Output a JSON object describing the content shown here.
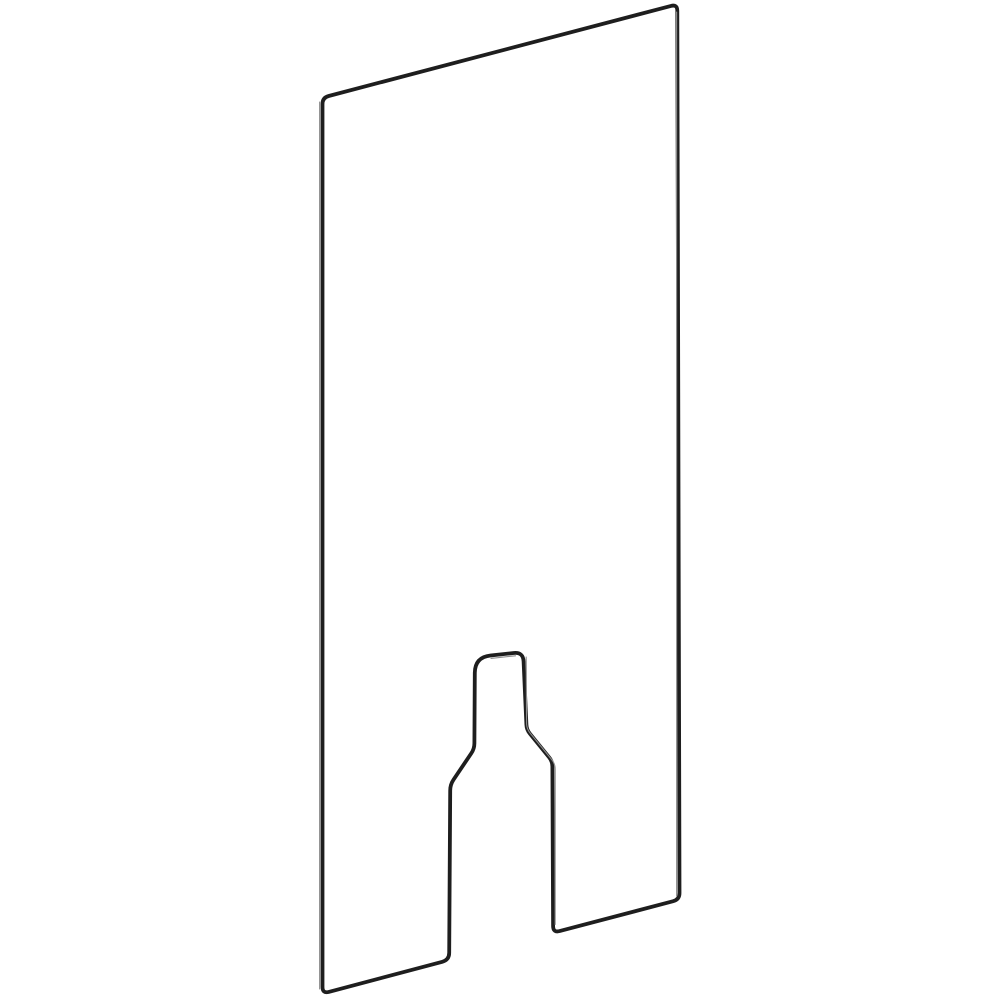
{
  "illustration": {
    "subject": "rectangular-panel-with-bottle-shaped-cutout",
    "view": "perspective-outline-drawing",
    "viewbox": "0 0 1000 1000",
    "colors": {
      "background": "#ffffff",
      "stroke_main": "#1e1e1e",
      "stroke_thin": "#8e8e8e"
    },
    "paths": {
      "panel_outline": "M 322.5 987 L 322.5 104 Q 322.5 97.6 328.7 96 L 671 5.9 Q 677.2 4.3 677.3 10.7 L 679.5 893 Q 679.5 899.5 673.2 901.2 L 559.6 931.1 Q 553.2 932.8 553.1 926.2 L 552.4 766.5 Q 552.4 761.3 549.2 757.4 L 529.8 733.6 Q 526.6 729.7 526.4 724.6 L 523.6 661.5 Q 523.2 652 513.8 653 L 490.5 655.5 Q 475 657.2 474.8 672.8 L 474.4 743.2 Q 474.4 748.8 471.2 753.4 L 453.6 779.6 Q 450.2 784.6 450.2 790.6 L 449.2 952.8 Q 449.2 959.9 442.3 961.8 L 328.8 991.9 Q 322.5 993.6 322.5 987 Z",
      "left_edge_thickness": "M 319.6 102 L 319.6 989",
      "right_edge_thickness": "M 676.6 12 L 676.6 896",
      "cutout_right_thickness": "M 526.2 657 L 526.6 724 Q 526.9 729.2 530.2 733.2 L 551.6 759.4 Q 555.2 763.8 555.2 769.2 L 555.2 924.5",
      "cutout_top_thickness": "M 491 658.4 L 515.5 655.8"
    }
  }
}
